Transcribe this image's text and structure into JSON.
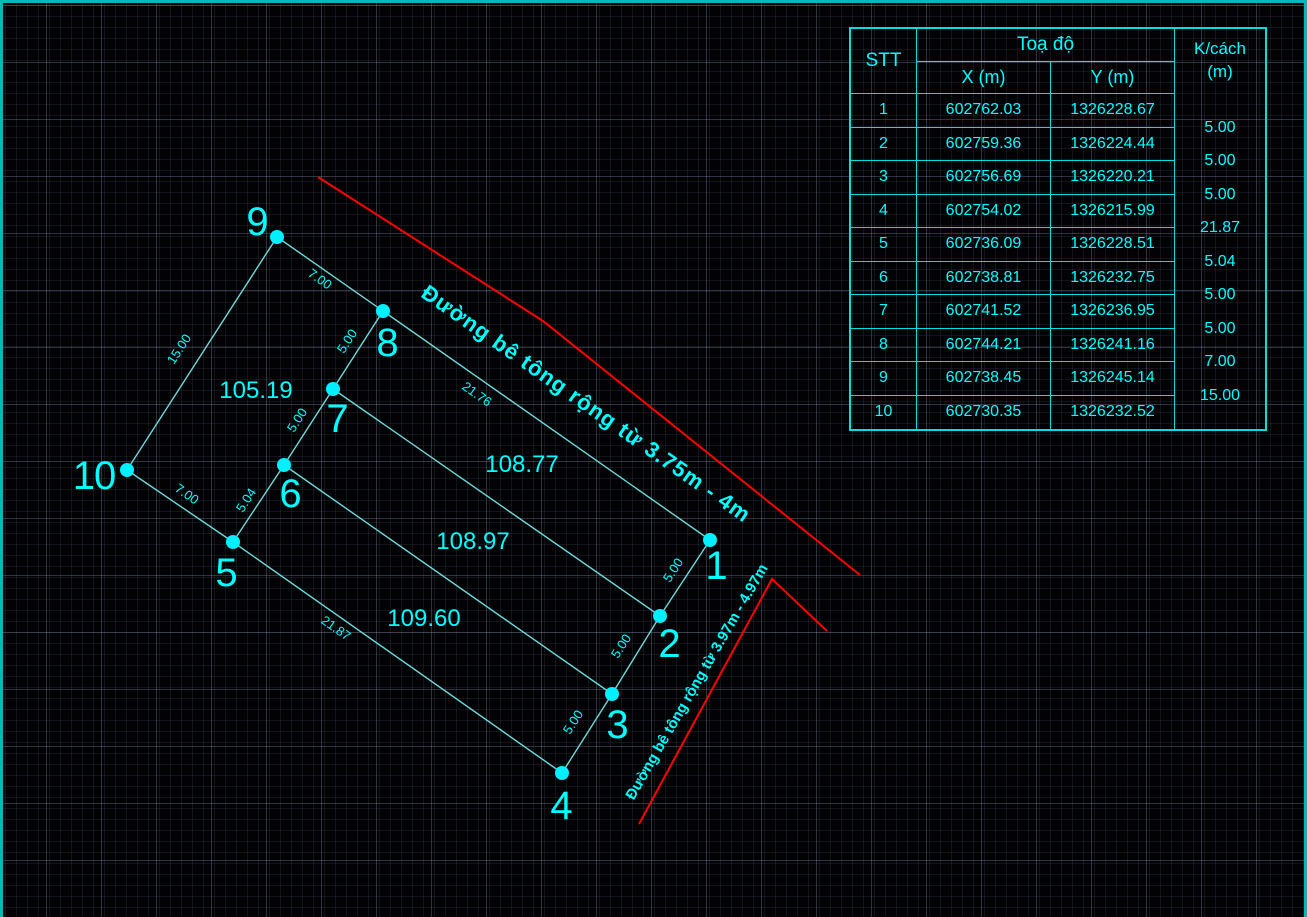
{
  "colors": {
    "cyan": "#00ffff",
    "parcel_line": "#6fd9d9",
    "road_red": "#ff0000",
    "table_border": "#00e0e0",
    "viewport_border": "#00b9b9"
  },
  "drawing": {
    "vertex_labels": [
      "1",
      "2",
      "3",
      "4",
      "5",
      "6",
      "7",
      "8",
      "9",
      "10"
    ],
    "edge_dimensions": {
      "v9_v8": "7.00",
      "v8_v7": "5.00",
      "v7_v6": "5.00",
      "v5_v6": "5.04",
      "v10_v5": "7.00",
      "v10_v9": "15.00",
      "v8_v1": "21.76",
      "v1_v2": "5.00",
      "v2_v3": "5.00",
      "v3_v4": "5.00",
      "v5_v4": "21.87"
    },
    "area_labels": [
      "105.19",
      "108.77",
      "108.97",
      "109.60"
    ],
    "road_labels": [
      "Đường bê tông rộng từ 3.75m - 4m",
      "Đường bê tông rộng từ 3.97m - 4.97m"
    ]
  },
  "table": {
    "col_stt": "STT",
    "col_toado": "Toạ độ",
    "col_x": "X (m)",
    "col_y": "Y (m)",
    "col_k_line1": "K/cách",
    "col_k_line2": "(m)",
    "rows": [
      {
        "stt": "1",
        "x": "602762.03",
        "y": "1326228.67"
      },
      {
        "stt": "2",
        "x": "602759.36",
        "y": "1326224.44"
      },
      {
        "stt": "3",
        "x": "602756.69",
        "y": "1326220.21"
      },
      {
        "stt": "4",
        "x": "602754.02",
        "y": "1326215.99"
      },
      {
        "stt": "5",
        "x": "602736.09",
        "y": "1326228.51"
      },
      {
        "stt": "6",
        "x": "602738.81",
        "y": "1326232.75"
      },
      {
        "stt": "7",
        "x": "602741.52",
        "y": "1326236.95"
      },
      {
        "stt": "8",
        "x": "602744.21",
        "y": "1326241.16"
      },
      {
        "stt": "9",
        "x": "602738.45",
        "y": "1326245.14"
      },
      {
        "stt": "10",
        "x": "602730.35",
        "y": "1326232.52"
      }
    ],
    "k_cach_values": [
      "5.00",
      "5.00",
      "5.00",
      "21.87",
      "5.04",
      "5.00",
      "5.00",
      "7.00",
      "15.00"
    ]
  }
}
